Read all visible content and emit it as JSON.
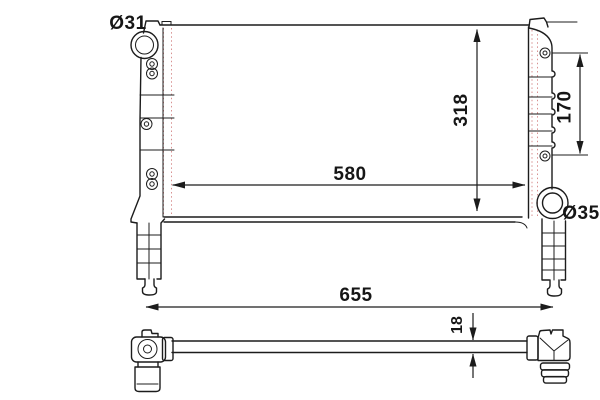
{
  "drawing": {
    "subject": "radiator-dimension-drawing",
    "colors": {
      "line": "#1c1c1c",
      "construction_line": "#d89191",
      "background": "#ffffff"
    },
    "labels": {
      "inlet_diameter": "Ø31",
      "core_height": "318",
      "bracket_spacing": "170",
      "core_width": "580",
      "outlet_diameter": "Ø35",
      "overall_length": "655",
      "core_depth": "18"
    }
  }
}
